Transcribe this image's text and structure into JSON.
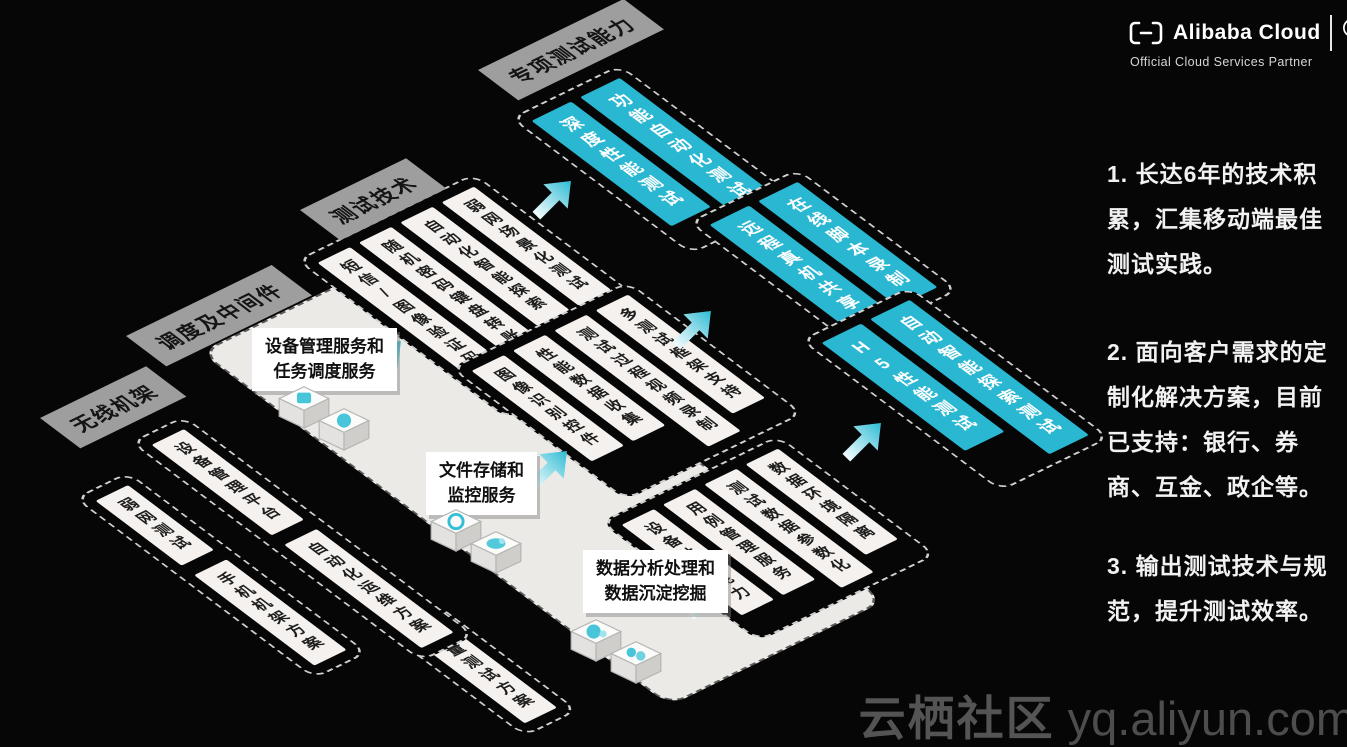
{
  "diagram": {
    "layers": [
      {
        "label": "无线机架",
        "groups": [
          {
            "bars": [
              "弱网测试",
              "手机机架方案"
            ]
          },
          {
            "bars": [
              "电量测试方案"
            ]
          }
        ]
      },
      {
        "label": "调度及中间件",
        "groups": [
          {
            "bars": [
              "设备管理平台",
              "自动化运维方案"
            ]
          }
        ]
      },
      {
        "label": "测试技术",
        "groups": [
          {
            "bars": [
              "弱网场景化测试",
              "自动化智能探索",
              "随机密码键盘转账",
              "短信/图像验证码登录"
            ]
          },
          {
            "bars": [
              "多测试框架支持",
              "测试过程视频录制",
              "性能数据收集",
              "图像识别控件"
            ]
          },
          {
            "bars": [
              "数据环境隔离",
              "测试数据参数化",
              "用例管理服务",
              "设备共享能力"
            ]
          }
        ]
      },
      {
        "label": "专项测试能力",
        "groups": [
          {
            "bars": [
              "功能自动化测试",
              "深度性能测试"
            ]
          },
          {
            "bars": [
              "在线脚本录制",
              "远程真机共享"
            ]
          },
          {
            "bars": [
              "自动智能探索测试",
              "H5性能测试"
            ]
          }
        ]
      }
    ],
    "callouts": [
      {
        "lines": [
          "设备管理服务和",
          "任务调度服务"
        ]
      },
      {
        "lines": [
          "文件存储和",
          "监控服务"
        ]
      },
      {
        "lines": [
          "数据分析处理和",
          "数据沉淀挖掘"
        ]
      }
    ]
  },
  "notes": [
    "1. 长达6年的技术积累，汇集移动端最佳测试实践。",
    "2. 面向客户需求的定制化解决方案，目前已支持：银行、券商、互金、政企等。",
    "3. 输出测试技术与规范，提升测试效率。"
  ],
  "logo": {
    "brand": "Alibaba Cloud",
    "subtitle": "Official Cloud Services Partner"
  },
  "watermark": {
    "site": "云栖社区",
    "url": " yq.aliyun.com"
  },
  "colors": {
    "accent_cyan": "#29b7d2",
    "bar_white": "#f4f1ee",
    "tag_gray": "#9e9e9e",
    "plateau_white": "#eceae7",
    "background": "#060606"
  }
}
